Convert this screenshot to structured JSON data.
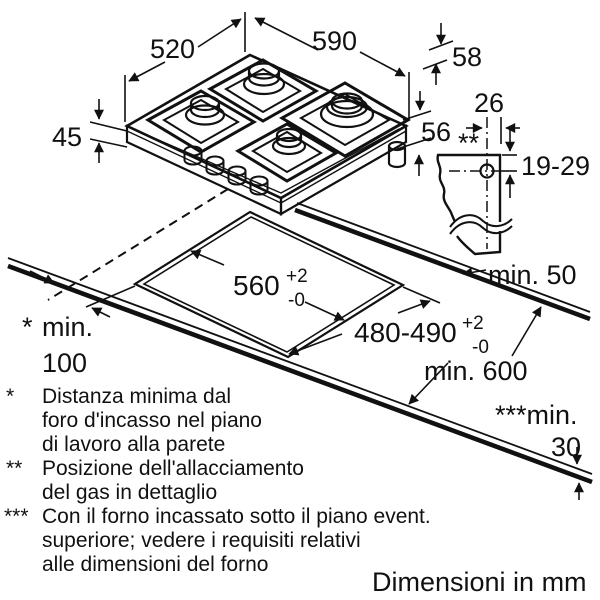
{
  "page": {
    "background": "#ffffff",
    "line_color": "#111111",
    "burner_fill": "#c9c9c9"
  },
  "dimensions": {
    "hob": {
      "depth": "520",
      "width": "590",
      "body_height": "45",
      "grate_height": "58",
      "connection_height": "56"
    },
    "gas_detail": {
      "offset": "26",
      "marker": "**",
      "vertical_range": "19-29",
      "rear_clearance": "min. 50"
    },
    "cutout": {
      "width": "560",
      "width_tol_up": "+2",
      "width_tol_down": "-0",
      "depth": "480-490",
      "depth_tol_up": "+2",
      "depth_tol_down": "-0"
    },
    "worktop": {
      "min_depth": "min. 600",
      "wall_marker": "*",
      "wall_min_line1": "min.",
      "wall_min_line2": "100",
      "thickness_label": "***min.",
      "thickness_value": "30"
    }
  },
  "footnotes": [
    {
      "marker": "*",
      "lines": [
        "Distanza minima dal",
        "foro d'incasso nel piano",
        "di lavoro alla parete"
      ]
    },
    {
      "marker": "**",
      "lines": [
        "Posizione dell'allacciamento",
        "del gas in dettaglio"
      ]
    },
    {
      "marker": "***",
      "lines": [
        "Con il forno incassato sotto il piano event.",
        "superiore; vedere i requisiti relativi",
        "alle dimensioni del forno"
      ]
    }
  ],
  "units_note": "Dimensioni in mm"
}
